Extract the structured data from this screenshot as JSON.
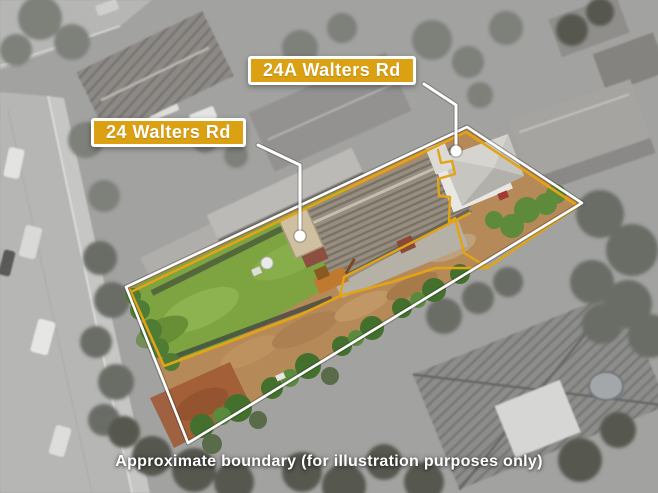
{
  "annotations": {
    "labels": [
      {
        "id": "24",
        "text": "24 Walters Rd"
      },
      {
        "id": "24a",
        "text": "24A Walters Rd"
      }
    ],
    "caption": "Approximate boundary (for illustration purposes only)"
  },
  "colors": {
    "base-gray": "#a2a2a0",
    "badge-bg": "#dba113",
    "badge-border": "#ffffff",
    "badge-text": "#ffffff",
    "boundary-yellow": "#e2a315",
    "boundary-white": "#ffffff",
    "caption-text": "#ffffff",
    "lawn-green": "#7da441",
    "dirt-tan": "#b68a58"
  }
}
